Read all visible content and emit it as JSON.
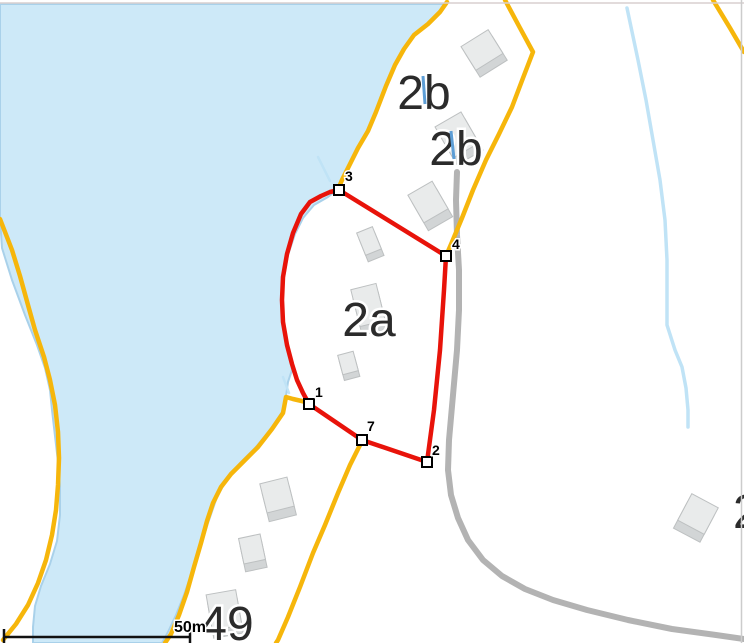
{
  "map": {
    "description": "cadastral map with red parcel polygon, lake, roads, buildings",
    "zone_labels": [
      {
        "text": "2b",
        "x": 424,
        "y": 109,
        "size": 48,
        "anchor": "middle"
      },
      {
        "text": "2b",
        "x": 456,
        "y": 165,
        "size": 48,
        "anchor": "middle"
      },
      {
        "text": "2a",
        "x": 369,
        "y": 336,
        "size": 48,
        "anchor": "middle"
      },
      {
        "text": "49",
        "x": 227,
        "y": 640,
        "size": 48,
        "anchor": "middle"
      },
      {
        "text": "2",
        "x": 733,
        "y": 528,
        "size": 48,
        "anchor": "start"
      }
    ],
    "vertices": [
      {
        "label": "1",
        "x": 309,
        "y": 404,
        "lx": 315,
        "ly": 397
      },
      {
        "label": "2",
        "x": 427,
        "y": 462,
        "lx": 432,
        "ly": 455
      },
      {
        "label": "3",
        "x": 339,
        "y": 190,
        "lx": 345,
        "ly": 181
      },
      {
        "label": "4",
        "x": 446,
        "y": 256,
        "lx": 452,
        "ly": 249
      },
      {
        "label": "7",
        "x": 362,
        "y": 440,
        "lx": 367,
        "ly": 431
      }
    ],
    "buildings": [
      {
        "x": 482,
        "y": 50,
        "w": 32,
        "h": 28,
        "rot": -32,
        "ext": 8
      },
      {
        "x": 457,
        "y": 135,
        "w": 30,
        "h": 36,
        "rot": -30,
        "ext": 8
      },
      {
        "x": 428,
        "y": 202,
        "w": 28,
        "h": 32,
        "rot": -30,
        "ext": 9
      },
      {
        "x": 369,
        "y": 241,
        "w": 17,
        "h": 24,
        "rot": -22,
        "ext": 7
      },
      {
        "x": 368,
        "y": 305,
        "w": 26,
        "h": 38,
        "rot": -14,
        "ext": 9
      },
      {
        "x": 348,
        "y": 363,
        "w": 16,
        "h": 20,
        "rot": -15,
        "ext": 6
      },
      {
        "x": 277,
        "y": 495,
        "w": 28,
        "h": 30,
        "rot": -14,
        "ext": 9
      },
      {
        "x": 252,
        "y": 549,
        "w": 22,
        "h": 26,
        "rot": -12,
        "ext": 8
      },
      {
        "x": 224,
        "y": 610,
        "w": 30,
        "h": 36,
        "rot": -10,
        "ext": 8
      },
      {
        "x": 698,
        "y": 514,
        "w": 30,
        "h": 30,
        "rot": 28,
        "ext": 9
      }
    ],
    "label_ticks": [
      {
        "x1": 423,
        "y1": 76,
        "x2": 425,
        "y2": 104
      },
      {
        "x1": 451,
        "y1": 131,
        "x2": 454,
        "y2": 159
      }
    ],
    "scale_bar": {
      "label": "50m",
      "x1": 4,
      "x2": 190,
      "y": 637,
      "tick_top": 629,
      "tick_bottom": 643,
      "label_x": 206,
      "label_y": 632
    },
    "colors": {
      "water": "#cde9f8",
      "water_edge": "#a9d1ea",
      "stream": "#c0e3f6",
      "label_tick_blue": "#5d9ed6",
      "road_yellow": "#f6b60b",
      "road_gray": "#b3b3b3",
      "parcel_red": "#e8130a",
      "building_top": "#e9ebeb",
      "building_side": "#d2d5d6",
      "building_stroke": "#bdc0c1",
      "label_dark": "#2b2b2b",
      "scale_black": "#111111",
      "border_top": "#d8cfcf",
      "border_right": "#cccccc"
    }
  }
}
